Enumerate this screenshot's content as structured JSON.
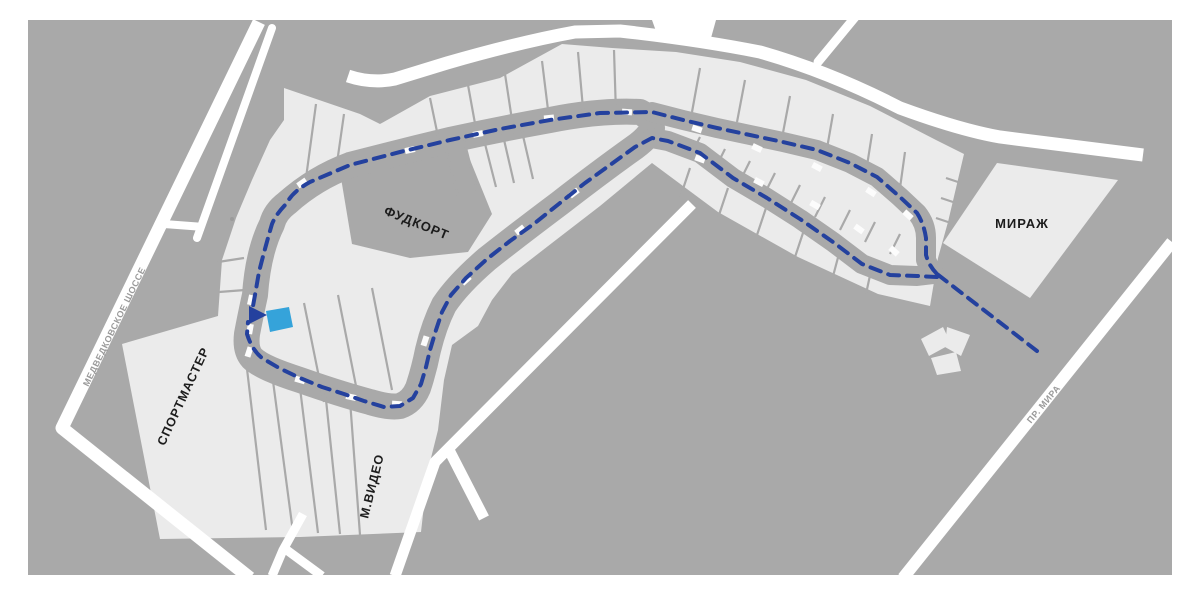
{
  "map": {
    "colors": {
      "page_bg": "#ffffff",
      "map_fill": "#a9a9a9",
      "building_fill": "#ebebeb",
      "kiosk_fill": "#fcfcfc",
      "road_fill": "#ffffff",
      "route_color": "#24419e",
      "highlight_color": "#35a3da",
      "store_label_color": "#1c1c1c",
      "road_label_color": "#9a9a9a"
    },
    "store_labels": {
      "foodcourt": "ФУДКОРТ",
      "mirage": "МИРАЖ",
      "sportmaster": "СПОРТМАСТЕР",
      "mvideo": "М.ВИДЕО"
    },
    "road_labels": {
      "left_highway": "МЕДВЕДКОВСКОЕ ШОССЕ",
      "right_avenue": "ПР. МИРА"
    }
  }
}
